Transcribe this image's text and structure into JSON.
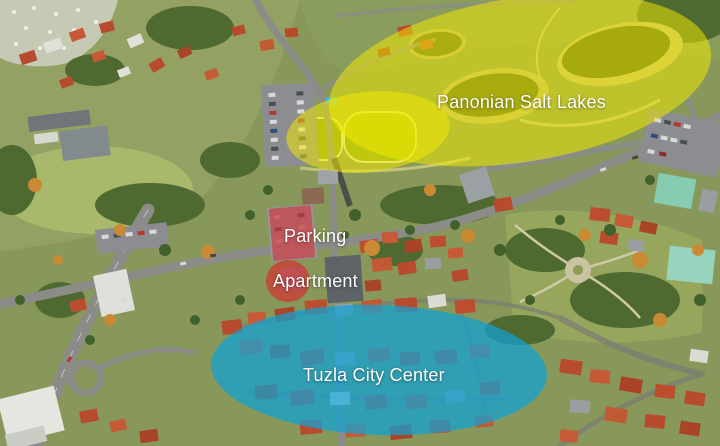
{
  "labels": {
    "salt_lakes": "Panonian Salt Lakes",
    "parking": "Parking",
    "apartment": "Apartment",
    "city_center": "Tuzla City Center"
  },
  "overlays": {
    "salt_lakes": {
      "color": "rgba(243,233,0,0.52)"
    },
    "parking": {
      "color": "rgba(222,36,42,0.55)"
    },
    "apartment": {
      "color": "rgba(222,36,42,0.62)"
    },
    "city_center": {
      "color": "rgba(16,162,214,0.72)"
    }
  },
  "colors": {
    "label_text": "#ffffff"
  }
}
